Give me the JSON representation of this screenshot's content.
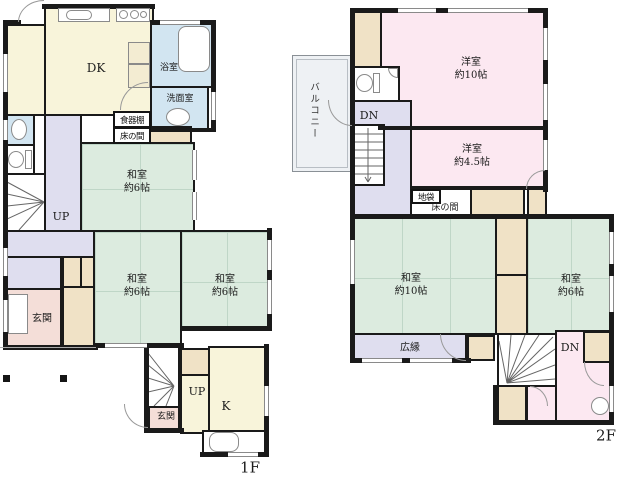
{
  "floor1": {
    "floor_label": "1F",
    "rooms": {
      "dk": "DK",
      "bath": "浴室",
      "washroom": "洗面室",
      "cupboard": "食器棚",
      "tokonoma": "床の間",
      "washitsu_a": {
        "line1": "和室",
        "line2": "約6帖"
      },
      "washitsu_b": {
        "line1": "和室",
        "line2": "約6帖"
      },
      "washitsu_c": {
        "line1": "和室",
        "line2": "約6帖"
      },
      "kitchen": "K",
      "genkan_main": "玄関",
      "genkan_sub": "玄関",
      "stairs_up_main": "UP",
      "stairs_up_sub": "UP"
    }
  },
  "floor2": {
    "floor_label": "2F",
    "rooms": {
      "balcony": "バルコニー",
      "stairs_dn_hall": "DN",
      "stairs_dn_room": "DN",
      "yoshitsu_10": {
        "line1": "洋室",
        "line2": "約10帖"
      },
      "yoshitsu_45": {
        "line1": "洋室",
        "line2": "約4.5帖"
      },
      "jibukuro": "地袋",
      "tokonoma": "床の間",
      "washitsu_10": {
        "line1": "和室",
        "line2": "約10帖"
      },
      "washitsu_6": {
        "line1": "和室",
        "line2": "約6帖"
      },
      "hiroen": "広縁"
    }
  },
  "colors": {
    "wall": "#1a1a1a",
    "tatami_green": "#dcebdf",
    "wood_cream": "#f8f4da",
    "water_blue": "#d2e5f1",
    "hall_lavender": "#dfdeef",
    "entrance_pink": "#f4ded8",
    "western_pink": "#fce8f1",
    "closet_tan": "#f0e2c6",
    "balcony_gray": "#eef1f4"
  }
}
